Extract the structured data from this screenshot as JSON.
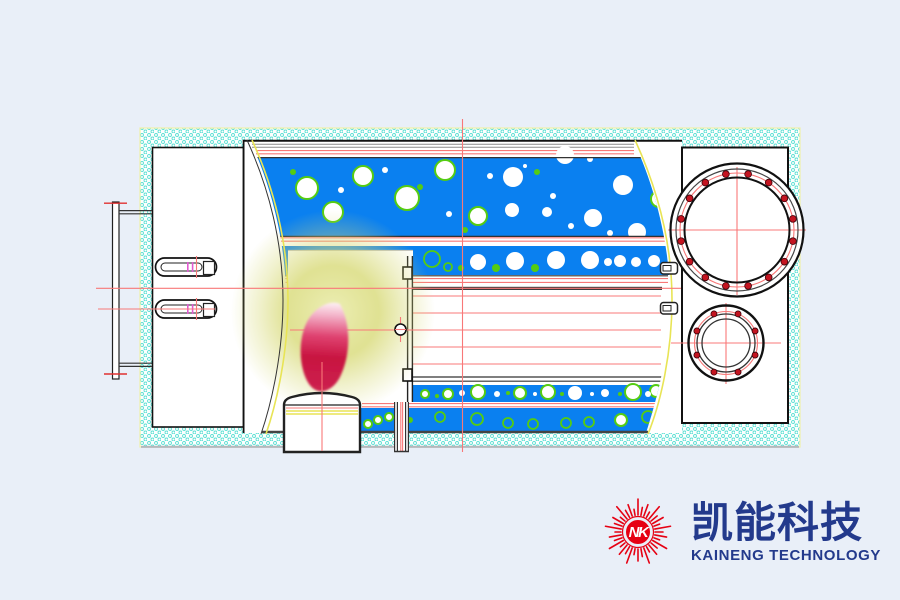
{
  "page": {
    "bg": "#e9eff8"
  },
  "logo": {
    "monogram": "NK",
    "cn": "凯能科技",
    "en": "KAINENG TECHNOLOGY",
    "colors": {
      "logo_red": "#e60113",
      "logo_navy": "#233a8c"
    },
    "star": {
      "count": 36,
      "inner_r": 17,
      "ring_r": 15.5,
      "disc_r": 12,
      "ray_lengths": [
        16,
        8,
        12,
        6
      ]
    }
  },
  "diagram": {
    "colors": {
      "blue": "#0a80f0",
      "hole_ring": "#55cc11",
      "centerline": "#f87878",
      "hatch": "#5ce0d4",
      "yellow_line": "#e8e455",
      "glow": "#d8da78",
      "flame_deep": "#c81440",
      "flame_light": "#fdeef2"
    },
    "holes": {
      "band1": [
        [
          307,
          188,
          11,
          "rw"
        ],
        [
          333,
          212,
          10,
          "rw"
        ],
        [
          363,
          176,
          10,
          "rw"
        ],
        [
          407,
          198,
          12,
          "rw"
        ],
        [
          445,
          170,
          10,
          "rw"
        ],
        [
          478,
          216,
          9,
          "rw"
        ],
        [
          659,
          199,
          8,
          "rw"
        ],
        [
          513,
          177,
          10,
          "w"
        ],
        [
          565,
          155,
          9,
          "w"
        ],
        [
          512,
          210,
          7,
          "w"
        ],
        [
          593,
          218,
          9,
          "w"
        ],
        [
          623,
          185,
          10,
          "w"
        ],
        [
          637,
          232,
          9,
          "w"
        ],
        [
          547,
          212,
          5,
          "w"
        ],
        [
          341,
          190,
          3,
          "wd"
        ],
        [
          385,
          170,
          3,
          "wd"
        ],
        [
          490,
          176,
          3,
          "wd"
        ],
        [
          553,
          196,
          3,
          "wd"
        ],
        [
          571,
          226,
          3,
          "wd"
        ],
        [
          590,
          159,
          3,
          "wd"
        ],
        [
          610,
          233,
          3,
          "wd"
        ],
        [
          449,
          214,
          3,
          "wd"
        ],
        [
          525,
          166,
          2,
          "wd"
        ],
        [
          293,
          172,
          3,
          "gd"
        ],
        [
          420,
          187,
          3,
          "gd"
        ],
        [
          537,
          172,
          3,
          "gd"
        ],
        [
          465,
          230,
          3,
          "gd"
        ],
        [
          648,
          168,
          2,
          "gd"
        ]
      ],
      "band2": [
        [
          272,
          262,
          6,
          "rh"
        ],
        [
          432,
          259,
          8,
          "rh"
        ],
        [
          448,
          267,
          4,
          "rh"
        ],
        [
          478,
          262,
          8,
          "w"
        ],
        [
          515,
          261,
          9,
          "w"
        ],
        [
          556,
          260,
          9,
          "w"
        ],
        [
          590,
          260,
          9,
          "w"
        ],
        [
          620,
          261,
          6,
          "w"
        ],
        [
          636,
          262,
          5,
          "w"
        ],
        [
          654,
          261,
          6,
          "w"
        ],
        [
          608,
          262,
          4,
          "wd"
        ],
        [
          461,
          268,
          3,
          "gd"
        ],
        [
          496,
          268,
          4,
          "gd"
        ],
        [
          535,
          268,
          4,
          "gd"
        ]
      ],
      "bandA": [
        [
          425,
          394,
          4,
          "rw"
        ],
        [
          448,
          394,
          5,
          "rw"
        ],
        [
          478,
          392,
          7,
          "rw"
        ],
        [
          520,
          393,
          6,
          "rw"
        ],
        [
          548,
          392,
          7,
          "rw"
        ],
        [
          633,
          392,
          8,
          "rw"
        ],
        [
          656,
          391,
          6,
          "rw"
        ],
        [
          575,
          393,
          7,
          "w"
        ],
        [
          605,
          393,
          4,
          "w"
        ],
        [
          462,
          393,
          3,
          "w"
        ],
        [
          497,
          394,
          3,
          "wd"
        ],
        [
          535,
          394,
          2,
          "wd"
        ],
        [
          592,
          394,
          2,
          "wd"
        ],
        [
          648,
          394,
          3,
          "wd"
        ],
        [
          437,
          396,
          2,
          "gd"
        ],
        [
          508,
          393,
          2,
          "gd"
        ],
        [
          562,
          394,
          2,
          "gd"
        ],
        [
          620,
          394,
          2,
          "gd"
        ]
      ],
      "bandB": [
        [
          368,
          424,
          4,
          "rw"
        ],
        [
          378,
          420,
          4,
          "rw"
        ],
        [
          389,
          417,
          4,
          "rw"
        ],
        [
          621,
          420,
          6,
          "rw"
        ],
        [
          440,
          417,
          5,
          "rh"
        ],
        [
          477,
          419,
          6,
          "rh"
        ],
        [
          508,
          423,
          5,
          "rh"
        ],
        [
          533,
          424,
          5,
          "rh"
        ],
        [
          566,
          423,
          5,
          "rh"
        ],
        [
          589,
          422,
          5,
          "rh"
        ],
        [
          648,
          417,
          6,
          "rh"
        ],
        [
          410,
          420,
          3,
          "gd"
        ]
      ]
    },
    "tube_rows_y": [
      296,
      313,
      347,
      364
    ],
    "flange_large": {
      "cx": 737,
      "cy": 230,
      "rings": [
        [
          66.5,
          "#111111",
          2.2
        ],
        [
          61,
          "#444444",
          1.2
        ],
        [
          52.5,
          "#111111",
          2
        ]
      ],
      "r_bolt_circle": 57,
      "bolt_count": 16,
      "bolt_r": 3.4,
      "bolt_offset_deg": 11.25,
      "cl_h": [
        668,
        806
      ],
      "cl_v": [
        167,
        295
      ]
    },
    "flange_small": {
      "cx": 726,
      "cy": 343,
      "rings": [
        [
          37.5,
          "#111111",
          2.4
        ],
        [
          29,
          "#333333",
          1.3
        ],
        [
          24,
          "#333333",
          1.3
        ]
      ],
      "r_bolt_circle": 31.5,
      "bolt_count": 8,
      "bolt_r": 3,
      "bolt_offset_deg": 22.5,
      "cl_h": [
        671,
        781
      ],
      "cl_v": [
        303,
        384
      ]
    }
  }
}
